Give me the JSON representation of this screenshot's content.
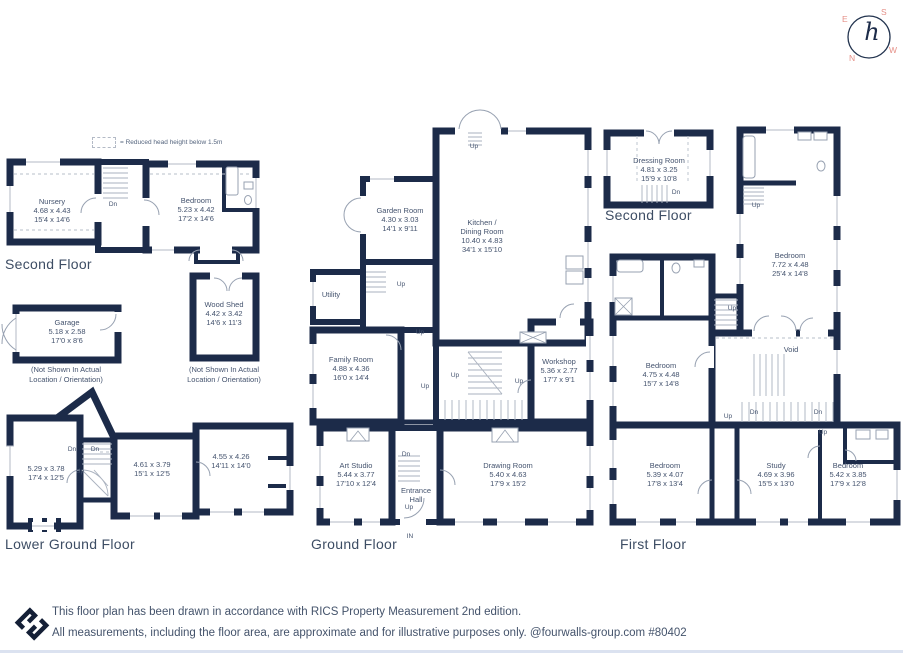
{
  "palette": {
    "wall": "#1c2b49",
    "label_text": "#44536e",
    "accent_salmon": "#e59088",
    "thin_line": "#97a1b1",
    "divider": "#dbe2f0"
  },
  "legend": {
    "text": "= Reduced head height below 1.5m"
  },
  "compass": {
    "east": "E",
    "south": "S",
    "north": "N",
    "west": "W",
    "monogram": "h"
  },
  "floor_labels": [
    {
      "id": "second-floor-left",
      "x": 5,
      "y": 256,
      "text": "Second Floor"
    },
    {
      "id": "lower-ground-floor",
      "x": 5,
      "y": 536,
      "text": "Lower Ground Floor"
    },
    {
      "id": "ground-floor",
      "x": 311,
      "y": 536,
      "text": "Ground Floor"
    },
    {
      "id": "second-floor-right",
      "x": 605,
      "y": 207,
      "text": "Second Floor"
    },
    {
      "id": "first-floor",
      "x": 620,
      "y": 536,
      "text": "First Floor"
    }
  ],
  "labels": [
    {
      "id": "nursery",
      "x": 52,
      "y": 197,
      "lines": [
        "Nursery",
        "4.68 x 4.43",
        "15'4 x 14'6"
      ]
    },
    {
      "id": "bedroom-sfl",
      "x": 196,
      "y": 196,
      "lines": [
        "Bedroom",
        "5.23 x 4.42",
        "17'2 x 14'6"
      ]
    },
    {
      "id": "garage",
      "x": 67,
      "y": 318,
      "lines": [
        "Garage",
        "5.18 x 2.58",
        "17'0 x 8'6"
      ]
    },
    {
      "id": "wood-shed",
      "x": 224,
      "y": 300,
      "lines": [
        "Wood Shed",
        "4.42 x 3.42",
        "14'6 x 11'3"
      ]
    },
    {
      "id": "lgf-room-1",
      "x": 46,
      "y": 464,
      "lines": [
        "5.29 x 3.78",
        "17'4 x 12'5"
      ]
    },
    {
      "id": "lgf-room-2",
      "x": 152,
      "y": 460,
      "lines": [
        "4.61 x 3.79",
        "15'1 x 12'5"
      ]
    },
    {
      "id": "lgf-room-3",
      "x": 231,
      "y": 452,
      "lines": [
        "4.55 x 4.26",
        "14'11 x 14'0"
      ]
    },
    {
      "id": "garden-room",
      "x": 400,
      "y": 206,
      "lines": [
        "Garden Room",
        "4.30 x 3.03",
        "14'1 x 9'11"
      ]
    },
    {
      "id": "kitchen-dining",
      "x": 482,
      "y": 218,
      "lines": [
        "Kitchen /",
        "Dining Room",
        "10.40 x 4.83",
        "34'1 x 15'10"
      ]
    },
    {
      "id": "utility",
      "x": 331,
      "y": 290,
      "lines": [
        "Utility"
      ]
    },
    {
      "id": "family-room",
      "x": 351,
      "y": 355,
      "lines": [
        "Family Room",
        "4.88 x 4.36",
        "16'0 x 14'4"
      ]
    },
    {
      "id": "workshop",
      "x": 559,
      "y": 357,
      "lines": [
        "Workshop",
        "5.36 x 2.77",
        "17'7 x 9'1"
      ]
    },
    {
      "id": "art-studio",
      "x": 356,
      "y": 461,
      "lines": [
        "Art Studio",
        "5.44 x 3.77",
        "17'10 x 12'4"
      ]
    },
    {
      "id": "entrance-hall",
      "x": 416,
      "y": 486,
      "lines": [
        "Entrance",
        "Hall"
      ]
    },
    {
      "id": "drawing-room",
      "x": 508,
      "y": 461,
      "lines": [
        "Drawing Room",
        "5.40 x 4.63",
        "17'9 x 15'2"
      ]
    },
    {
      "id": "dressing-room",
      "x": 659,
      "y": 156,
      "lines": [
        "Dressing Room",
        "4.81 x 3.25",
        "15'9 x 10'8"
      ]
    },
    {
      "id": "ff-bedroom-772",
      "x": 790,
      "y": 251,
      "lines": [
        "Bedroom",
        "7.72 x 4.48",
        "25'4 x 14'8"
      ]
    },
    {
      "id": "ff-bedroom-475",
      "x": 661,
      "y": 361,
      "lines": [
        "Bedroom",
        "4.75 x 4.48",
        "15'7 x 14'8"
      ]
    },
    {
      "id": "void",
      "x": 791,
      "y": 345,
      "lines": [
        "Void"
      ]
    },
    {
      "id": "ff-bedroom-539",
      "x": 665,
      "y": 461,
      "lines": [
        "Bedroom",
        "5.39 x 4.07",
        "17'8 x 13'4"
      ]
    },
    {
      "id": "study",
      "x": 776,
      "y": 461,
      "lines": [
        "Study",
        "4.69 x 3.96",
        "15'5 x 13'0"
      ]
    },
    {
      "id": "ff-bedroom-542",
      "x": 848,
      "y": 461,
      "lines": [
        "Bedroom",
        "5.42 x 3.85",
        "17'9 x 12'8"
      ]
    }
  ],
  "notes": [
    {
      "id": "garage-note",
      "x": 66,
      "y": 365,
      "lines": [
        "(Not Shown In Actual",
        "Location / Orientation)"
      ]
    },
    {
      "id": "wood-shed-note",
      "x": 224,
      "y": 365,
      "lines": [
        "(Not Shown In Actual",
        "Location / Orientation)"
      ]
    }
  ],
  "stair_labels": [
    {
      "x": 113,
      "y": 201,
      "text": "Dn"
    },
    {
      "x": 72,
      "y": 446,
      "text": "Dn"
    },
    {
      "x": 95,
      "y": 446,
      "text": "Dn"
    },
    {
      "x": 80,
      "y": 468,
      "text": "Up"
    },
    {
      "x": 474,
      "y": 143,
      "text": "Up"
    },
    {
      "x": 401,
      "y": 281,
      "text": "Up"
    },
    {
      "x": 420,
      "y": 329,
      "text": "Up"
    },
    {
      "x": 425,
      "y": 383,
      "text": "Up"
    },
    {
      "x": 455,
      "y": 372,
      "text": "Up"
    },
    {
      "x": 519,
      "y": 378,
      "text": "Up"
    },
    {
      "x": 406,
      "y": 451,
      "text": "Dn"
    },
    {
      "x": 409,
      "y": 504,
      "text": "Up"
    },
    {
      "x": 410,
      "y": 533,
      "text": "IN"
    },
    {
      "x": 676,
      "y": 189,
      "text": "Dn"
    },
    {
      "x": 756,
      "y": 202,
      "text": "Up"
    },
    {
      "x": 732,
      "y": 305,
      "text": "Up"
    },
    {
      "x": 728,
      "y": 413,
      "text": "Up"
    },
    {
      "x": 754,
      "y": 409,
      "text": "Dn"
    },
    {
      "x": 818,
      "y": 409,
      "text": "Dn"
    },
    {
      "x": 823,
      "y": 429,
      "text": "Up"
    }
  ],
  "footer": {
    "line1": "This floor plan has been drawn in accordance with RICS Property Measurement 2nd edition.",
    "line2": "All measurements, including the floor area, are approximate and for illustrative purposes only. @fourwalls-group.com #80402"
  }
}
